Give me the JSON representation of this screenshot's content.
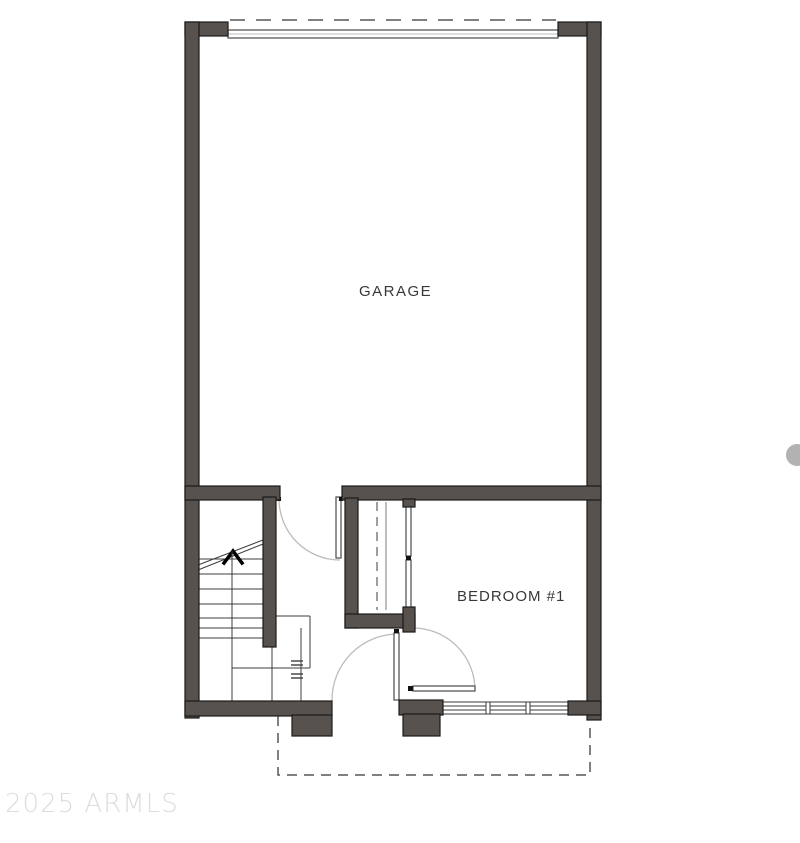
{
  "plan": {
    "garage_label": "GARAGE",
    "bedroom_label": "BEDROOM #1",
    "watermark": "2025 ARMLS",
    "features": {
      "garage_door": "overhead garage door (dashed track)",
      "stairs": "staircase with up arrow",
      "closet": "closet with rod and shelf",
      "entry_door": "front entry door",
      "bedroom_door": "bedroom swing door",
      "window": "triple window",
      "patio": "dashed patio outline"
    }
  },
  "colors": {
    "wall": "#57524e",
    "wall_edge": "#1b1b1b",
    "line": "#3e3e3e",
    "arc": "#bcbcbc",
    "leaf_edge": "#4a4a4a",
    "dash": "#565656",
    "watermark": "#dcdcdc",
    "dot": "#b2b2b2",
    "label": "#383838",
    "window_edge": "#3a3a3a"
  }
}
